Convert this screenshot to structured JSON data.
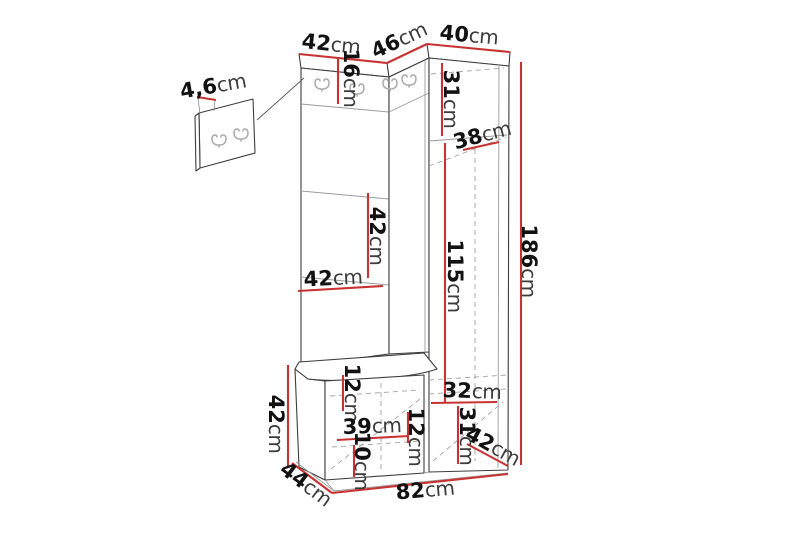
{
  "diagram_title": "hallway-furniture-dimension-diagram",
  "colors": {
    "dimension_line": "#c83232",
    "edge": "#3d3d3d",
    "hidden_edge": "#a3a3a3",
    "hook": "#ababab",
    "number_text": "#121212",
    "unit_text": "#3c3c3c",
    "background": "#ffffff"
  },
  "dimensions": {
    "detail_thickness": {
      "value": "4,6",
      "unit": "cm"
    },
    "top_width_left": {
      "value": "42",
      "unit": "cm"
    },
    "top_width_middle": {
      "value": "46",
      "unit": "cm"
    },
    "top_width_right": {
      "value": "40",
      "unit": "cm"
    },
    "hook_panel_height": {
      "value": "16",
      "unit": "cm"
    },
    "wardrobe_top_height": {
      "value": "31",
      "unit": "cm"
    },
    "wardrobe_shelf_diagonal": {
      "value": "38",
      "unit": "cm"
    },
    "wardrobe_door_height": {
      "value": "115",
      "unit": "cm"
    },
    "total_height": {
      "value": "186",
      "unit": "cm"
    },
    "shelf_gap_height": {
      "value": "42",
      "unit": "cm"
    },
    "shelf_width": {
      "value": "42",
      "unit": "cm"
    },
    "bench_height": {
      "value": "42",
      "unit": "cm"
    },
    "bench_top_gap": {
      "value": "12",
      "unit": "cm"
    },
    "bench_inner_width": {
      "value": "39",
      "unit": "cm"
    },
    "bench_inner_right": {
      "value": "12",
      "unit": "cm"
    },
    "bench_bottom_gap": {
      "value": "10",
      "unit": "cm"
    },
    "wardrobe_bottom_width": {
      "value": "32",
      "unit": "cm"
    },
    "wardrobe_bottom_height": {
      "value": "31",
      "unit": "cm"
    },
    "wardrobe_depth": {
      "value": "42",
      "unit": "cm"
    },
    "bench_depth": {
      "value": "44",
      "unit": "cm"
    },
    "total_width": {
      "value": "82",
      "unit": "cm"
    }
  }
}
